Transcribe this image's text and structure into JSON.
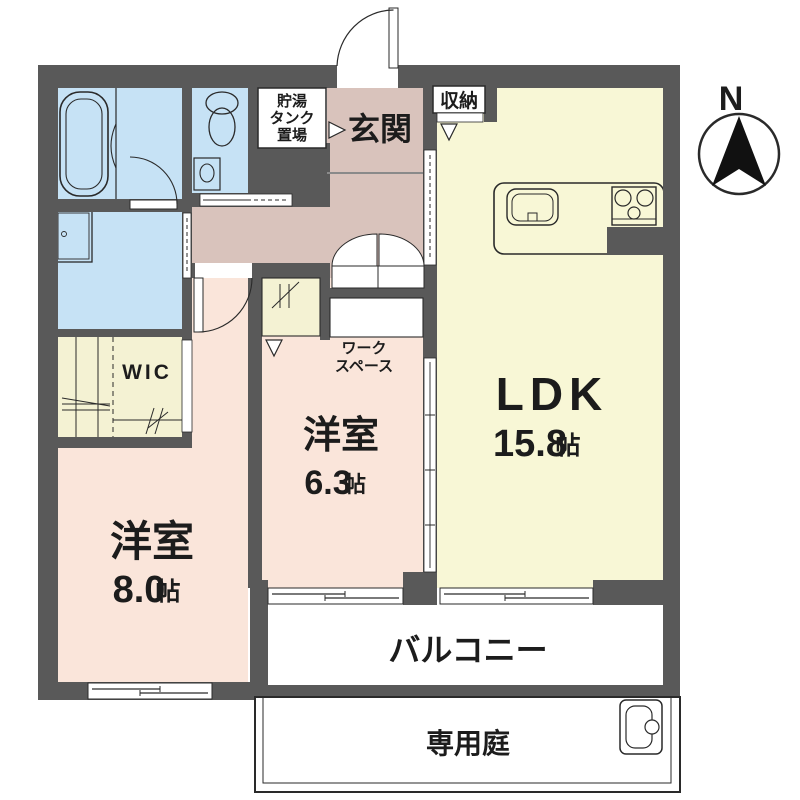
{
  "plan_title": "apartment-floor-plan",
  "colors": {
    "wall": "#595959",
    "water": "#c6e2f5",
    "hall": "#d9c3bc",
    "bed": "#fae5da",
    "ldk": "#f8f7d6",
    "closet": "#f4f2d3",
    "line": "#2a2a2a",
    "text": "#1c1c1c"
  },
  "compass": {
    "label": "N"
  },
  "rooms": {
    "entrance": {
      "label": "玄関"
    },
    "tank": {
      "lines": [
        "貯湯",
        "タンク",
        "置場"
      ]
    },
    "storage": {
      "label": "収納"
    },
    "wic": {
      "label": "WIC"
    },
    "bedroom1": {
      "label": "洋室",
      "size": "8.0",
      "unit": "帖"
    },
    "bedroom2": {
      "label": "洋室",
      "size": "6.3",
      "unit": "帖"
    },
    "ldk": {
      "label": "LDK",
      "size": "15.8",
      "unit": "帖"
    },
    "workspace": {
      "lines": [
        "ワーク",
        "スペース"
      ]
    },
    "balcony": {
      "label": "バルコニー"
    },
    "garden": {
      "label": "専用庭"
    }
  },
  "icons": {
    "bathtub": "bathtub-icon",
    "toilet": "toilet-icon",
    "vanity": "vanity-sink-icon",
    "kitchen_sink": "kitchen-sink-icon",
    "stove": "gas-stove-icon",
    "slop_sink": "garden-sink-icon",
    "compass": "north-compass-icon"
  }
}
